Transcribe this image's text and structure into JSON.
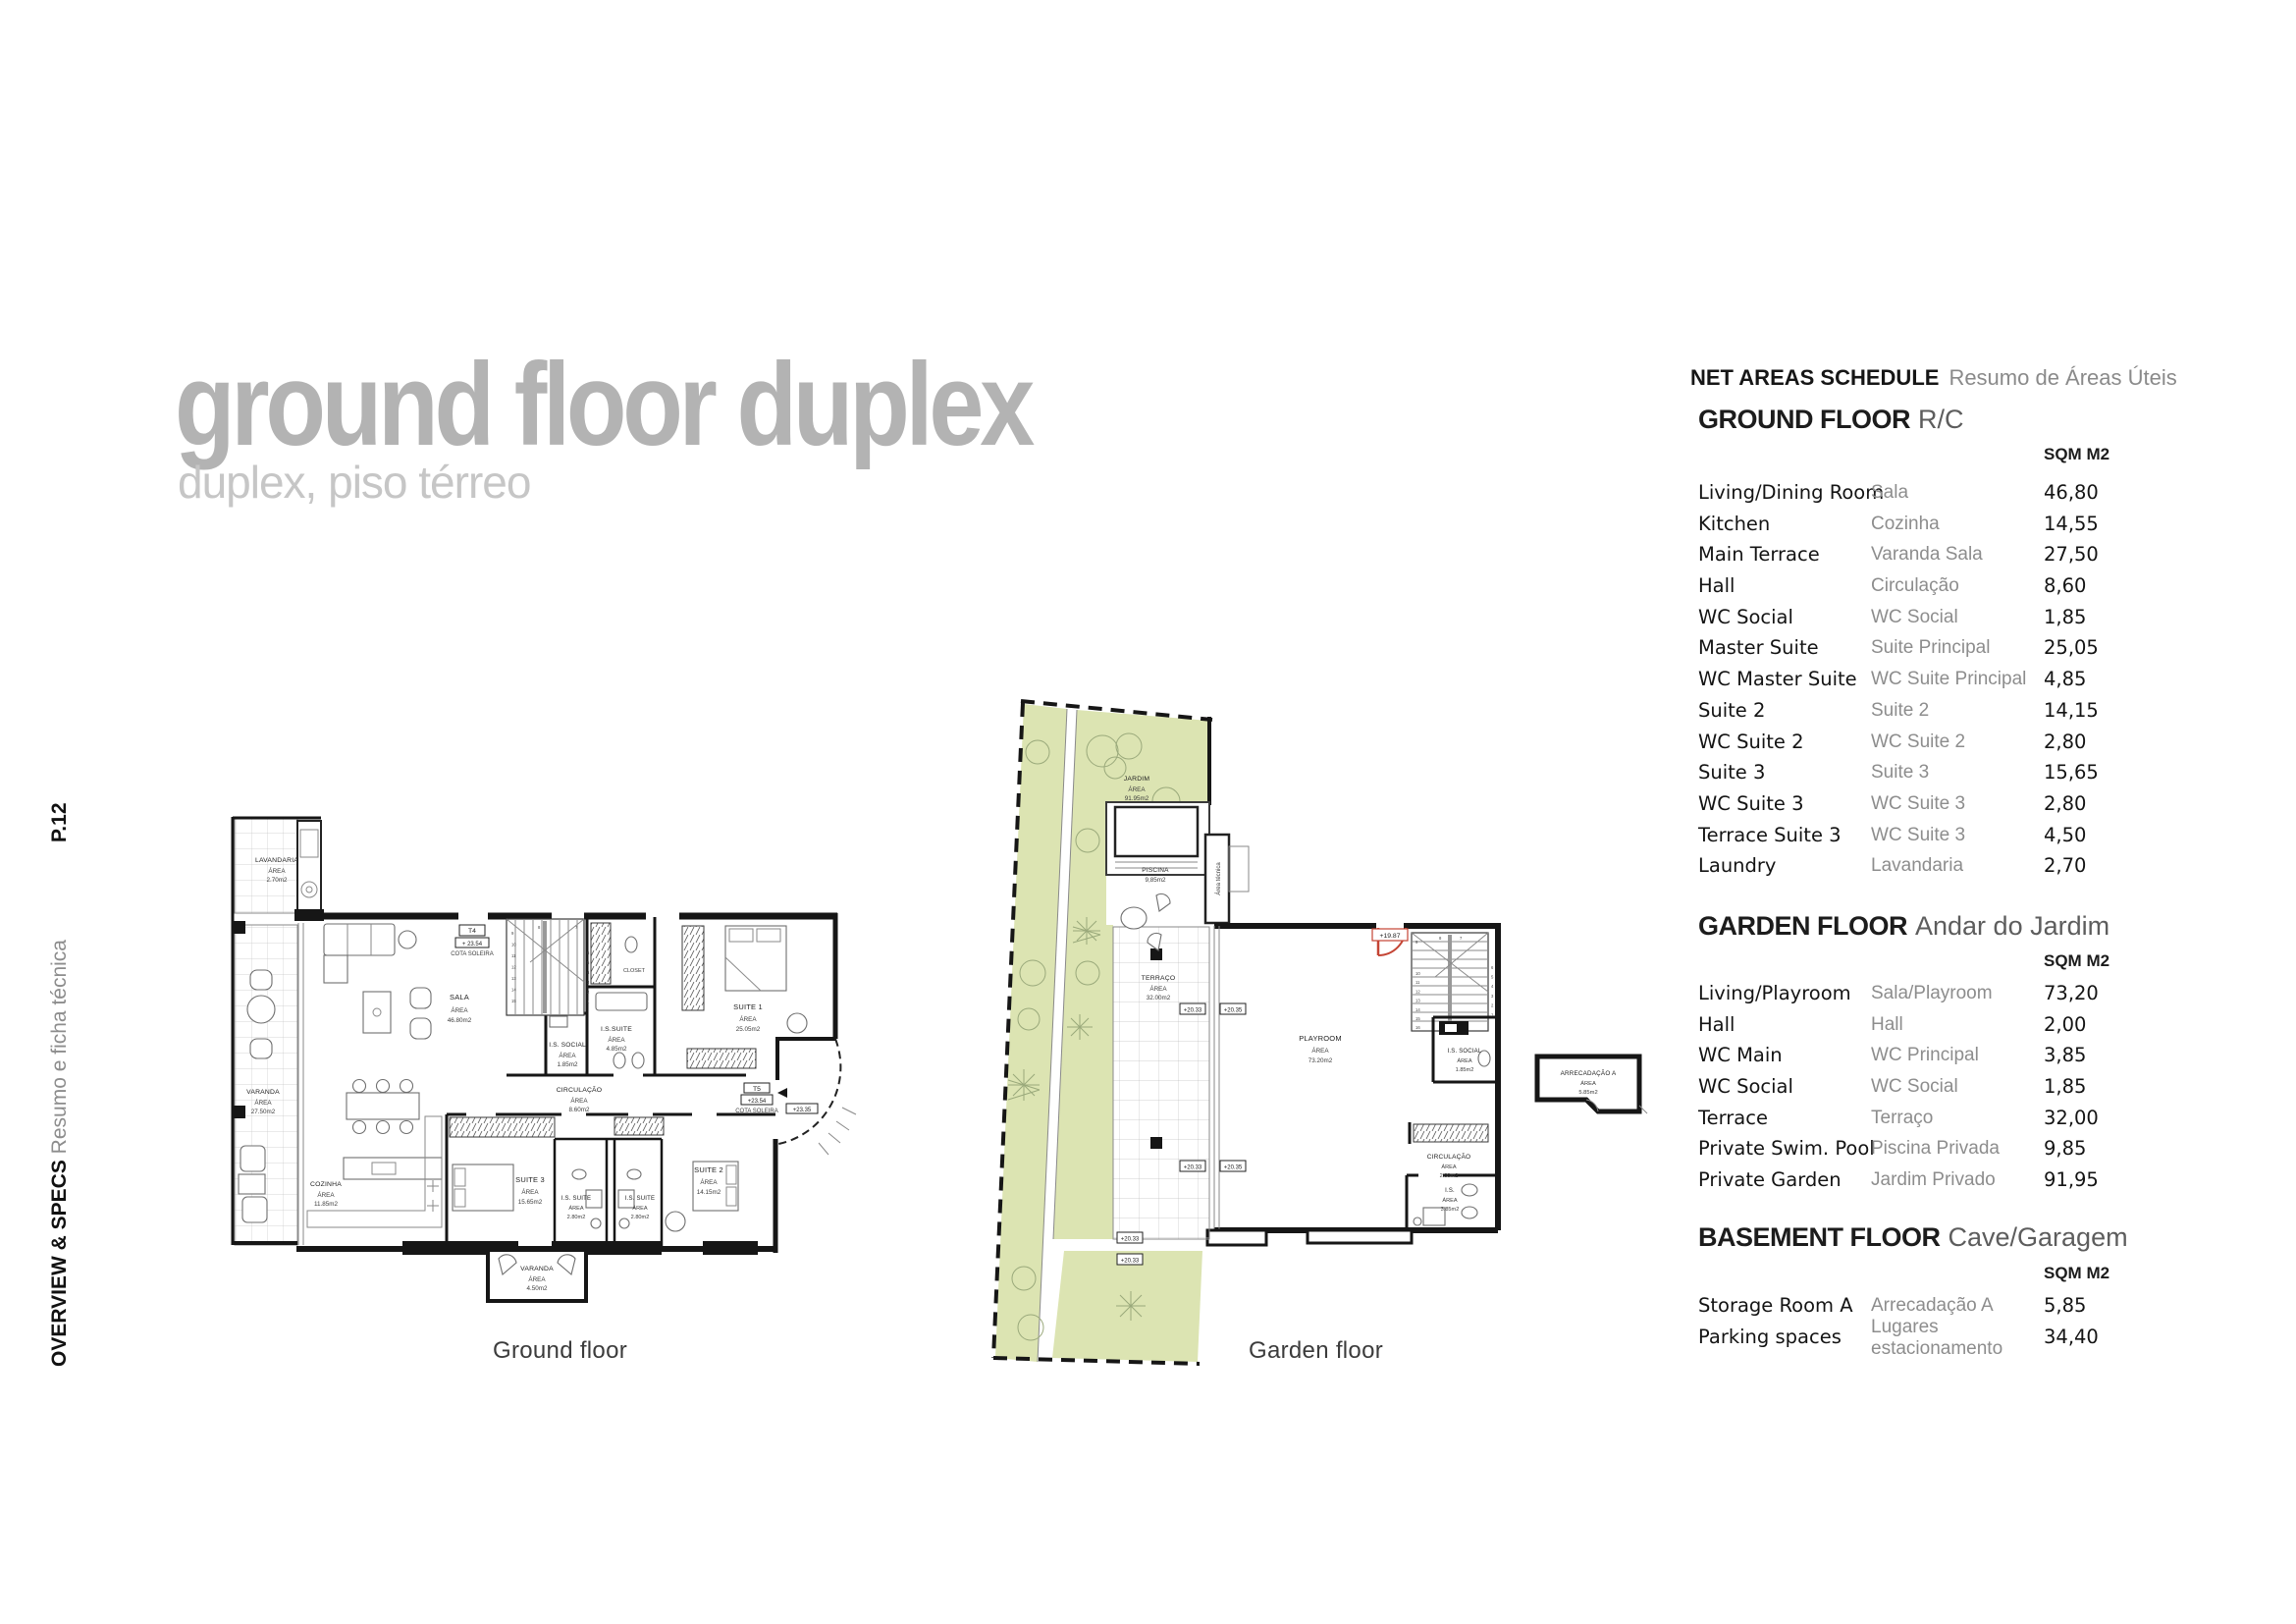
{
  "page": {
    "number_label": "P.12",
    "side_heading": "OVERVIEW & SPECS",
    "side_subheading": "Resumo e ficha técnica",
    "title": "ground floor duplex",
    "subtitle": "duplex, piso térreo"
  },
  "colors": {
    "garden_green": "#dce4b2",
    "accent_red": "#c44434",
    "title_gray": "#b3b3b3"
  },
  "schedule": {
    "title_en": "NET AREAS SCHEDULE",
    "title_pt": "Resumo de Áreas Úteis",
    "sections": [
      {
        "heading_en": "GROUND FLOOR",
        "heading_pt": "R/C",
        "unit_label": "SQM M2",
        "rows": [
          {
            "en": "Living/Dining Room",
            "pt": "Sala",
            "sqm": "46,80"
          },
          {
            "en": "Kitchen",
            "pt": "Cozinha",
            "sqm": "14,55"
          },
          {
            "en": "Main Terrace",
            "pt": "Varanda Sala",
            "sqm": "27,50"
          },
          {
            "en": "Hall",
            "pt": "Circulação",
            "sqm": "8,60"
          },
          {
            "en": "WC Social",
            "pt": "WC Social",
            "sqm": "1,85"
          },
          {
            "en": "Master Suite",
            "pt": "Suite Principal",
            "sqm": "25,05"
          },
          {
            "en": "WC Master Suite",
            "pt": "WC Suite Principal",
            "sqm": "4,85"
          },
          {
            "en": "Suite 2",
            "pt": "Suite 2",
            "sqm": "14,15"
          },
          {
            "en": "WC Suite 2",
            "pt": "WC Suite 2",
            "sqm": "2,80"
          },
          {
            "en": "Suite 3",
            "pt": "Suite 3",
            "sqm": "15,65"
          },
          {
            "en": "WC Suite 3",
            "pt": "WC Suite 3",
            "sqm": "2,80"
          },
          {
            "en": "Terrace Suite 3",
            "pt": "WC Suite 3",
            "sqm": "4,50"
          },
          {
            "en": "Laundry",
            "pt": "Lavandaria",
            "sqm": "2,70"
          }
        ]
      },
      {
        "heading_en": "GARDEN FLOOR",
        "heading_pt": "Andar do Jardim",
        "unit_label": "SQM M2",
        "rows": [
          {
            "en": "Living/Playroom",
            "pt": "Sala/Playroom",
            "sqm": "73,20"
          },
          {
            "en": "Hall",
            "pt": "Hall",
            "sqm": "2,00"
          },
          {
            "en": "WC Main",
            "pt": "WC Principal",
            "sqm": "3,85"
          },
          {
            "en": "WC Social",
            "pt": "WC Social",
            "sqm": "1,85"
          },
          {
            "en": "Terrace",
            "pt": "Terraço",
            "sqm": "32,00"
          },
          {
            "en": "Private Swim. Pool",
            "pt": "Piscina Privada",
            "sqm": "9,85"
          },
          {
            "en": "Private Garden",
            "pt": "Jardim Privado",
            "sqm": "91,95"
          }
        ]
      },
      {
        "heading_en": "BASEMENT FLOOR",
        "heading_pt": "Cave/Garagem",
        "unit_label": "SQM M2",
        "rows": [
          {
            "en": "Storage Room A",
            "pt": "Arrecadação A",
            "sqm": "5,85"
          },
          {
            "en": "Parking spaces",
            "pt": "Lugares\nestacionamento",
            "sqm": "34,40"
          }
        ]
      }
    ]
  },
  "plans": {
    "ground": {
      "caption": "Ground floor",
      "rooms": {
        "lavandaria": [
          "LAVANDARIA",
          "ÁREA",
          "2.70m2"
        ],
        "sala": [
          "SALA",
          "ÁREA",
          "46.80m2"
        ],
        "closet": [
          "CLOSET"
        ],
        "is_suite": [
          "I.S.SUITE",
          "ÁREA",
          "4.85m2"
        ],
        "is_social": [
          "I.S. SOCIAL",
          "ÁREA",
          "1.85m2"
        ],
        "suite1": [
          "SUITE 1",
          "ÁREA",
          "25.05m2"
        ],
        "circulacao": [
          "CIRCULAÇÃO",
          "ÁREA",
          "8.60m2"
        ],
        "suite3": [
          "SUITE 3",
          "ÁREA",
          "15.65m2"
        ],
        "is_suite3": [
          "I.S. SUITE",
          "ÁREA",
          "2.80m2"
        ],
        "is_suite2": [
          "I.S. SUITE",
          "ÁREA",
          "2.80m2"
        ],
        "suite2": [
          "SUITE 2",
          "ÁREA",
          "14.15m2"
        ],
        "cozinha": [
          "COZINHA",
          "ÁREA",
          "11.85m2"
        ],
        "varanda": [
          "VARANDA",
          "ÁREA",
          "27.50m2"
        ],
        "varanda_sul": [
          "VARANDA",
          "ÁREA",
          "4.50m2"
        ]
      },
      "markers": {
        "t4": [
          "T4",
          "+ 23.54",
          "COTA SOLEIRA"
        ],
        "t5": [
          "T5",
          "+23.54",
          "COTA SOLEIRA"
        ],
        "cota": "+23.35"
      },
      "stair_numbers": [
        "1",
        "2",
        "3",
        "4",
        "5",
        "6",
        "7",
        "8",
        "9",
        "10",
        "11",
        "12",
        "13",
        "14",
        "15"
      ]
    },
    "garden": {
      "caption": "Garden floor",
      "rooms": {
        "jardim": [
          "JARDIM",
          "ÁREA",
          "91.95m2"
        ],
        "piscina": [
          "PISCINA",
          "9,85m2"
        ],
        "area_tecnica": "Área técnica",
        "terraco": [
          "TERRAÇO",
          "ÁREA",
          "32.00m2"
        ],
        "playroom": [
          "PLAYROOM",
          "ÁREA",
          "73.20m2"
        ],
        "is_social": [
          "I.S. SOCIAL",
          "ÁREA",
          "1.85m2"
        ],
        "circulacao": [
          "CIRCULAÇÃO",
          "ÁREA",
          "2.00m2"
        ],
        "is": [
          "I.S.",
          "ÁREA",
          "3.85m2"
        ],
        "arrecadacao": [
          "ARRECADAÇÃO A",
          "ÁREA",
          "5.85m2"
        ]
      },
      "markers": {
        "door": "+19.87",
        "m1": "+20.33",
        "m2": "+20.35",
        "m3": "+20.33",
        "m4": "+20.35",
        "m5": "+20.33",
        "m6": "+20.33"
      },
      "stair_numbers": [
        "1",
        "2",
        "3",
        "4",
        "5",
        "6",
        "7",
        "8",
        "9",
        "10",
        "11",
        "12",
        "13",
        "14",
        "15",
        "16"
      ]
    }
  }
}
